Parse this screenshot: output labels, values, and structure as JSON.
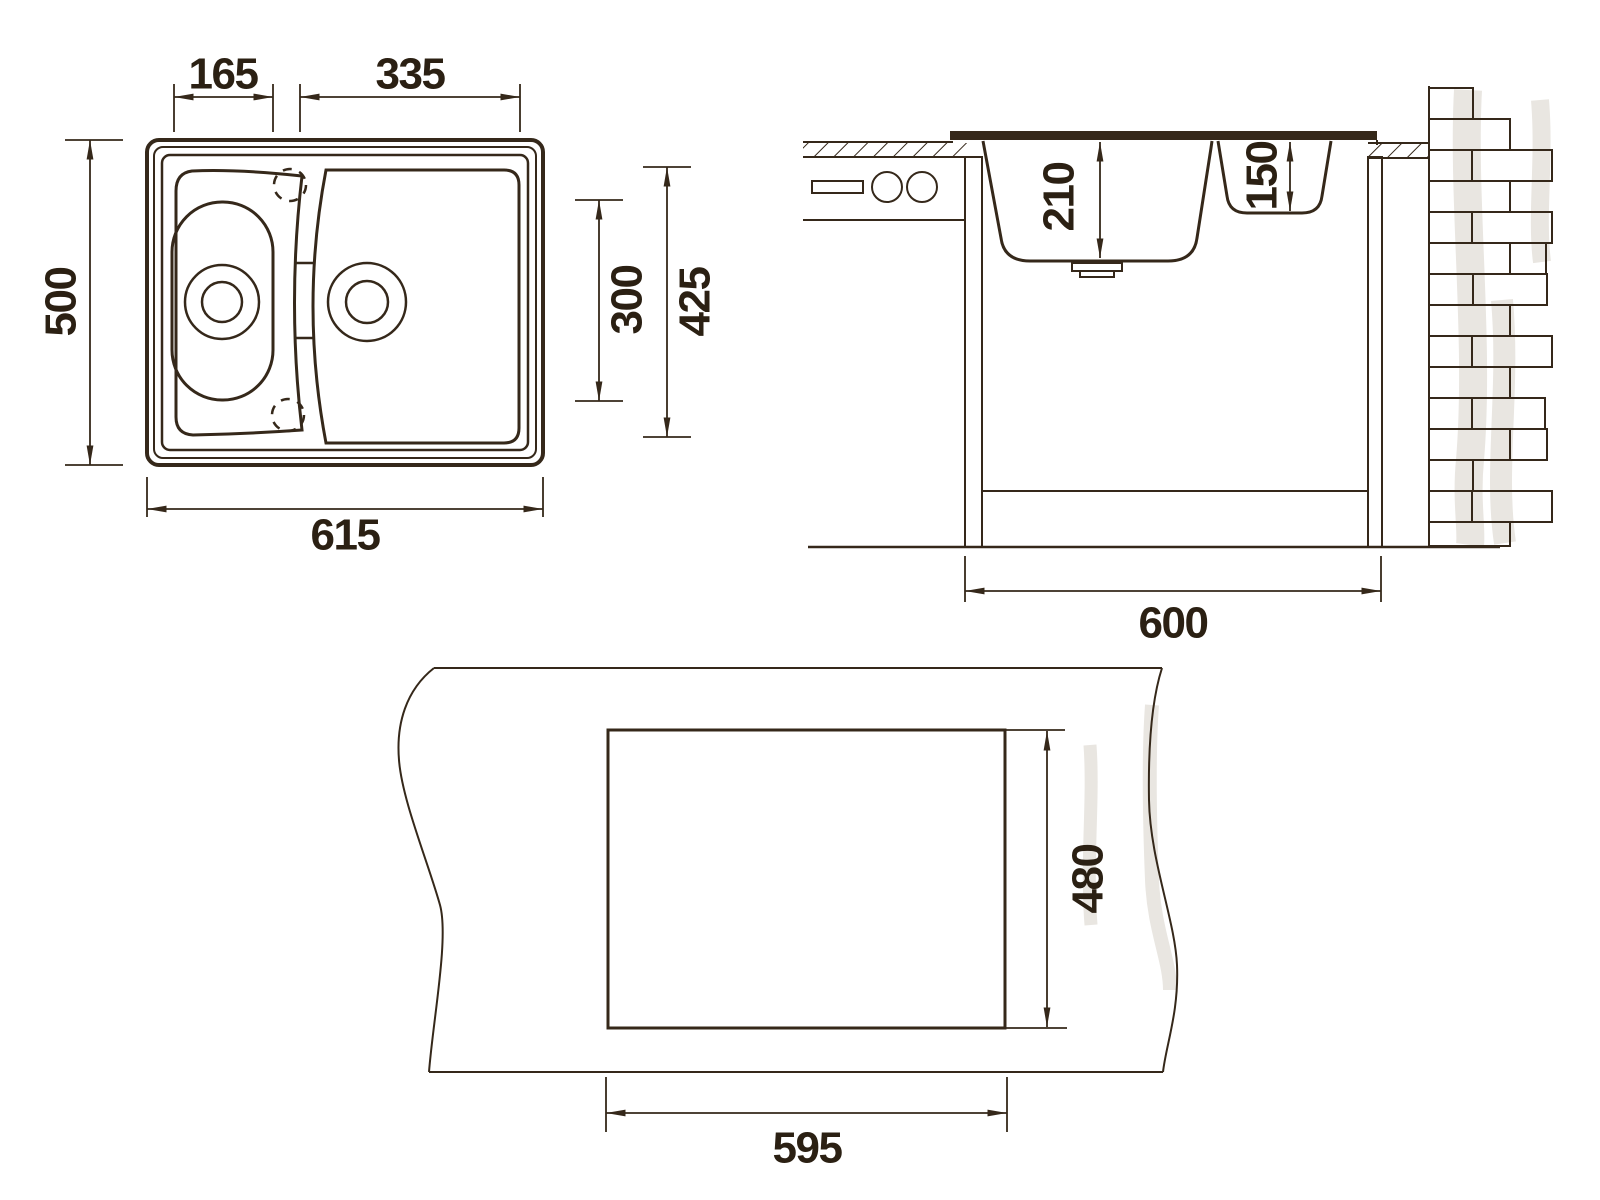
{
  "colors": {
    "line": "#35281a",
    "text": "#2b2013",
    "shadow": "#e9e6e1",
    "background": "#ffffff"
  },
  "plan_view": {
    "dimensions": {
      "small_bowl_width": "165",
      "main_bowl_width": "335",
      "overall_depth": "500",
      "overall_width": "615",
      "bowls_inner_length": "300",
      "bowls_area_length": "425"
    }
  },
  "section_view": {
    "dimensions": {
      "main_bowl_depth": "210",
      "small_bowl_depth": "150",
      "cabinet_width": "600"
    }
  },
  "cutout_view": {
    "dimensions": {
      "cutout_width": "595",
      "cutout_depth": "480"
    }
  }
}
